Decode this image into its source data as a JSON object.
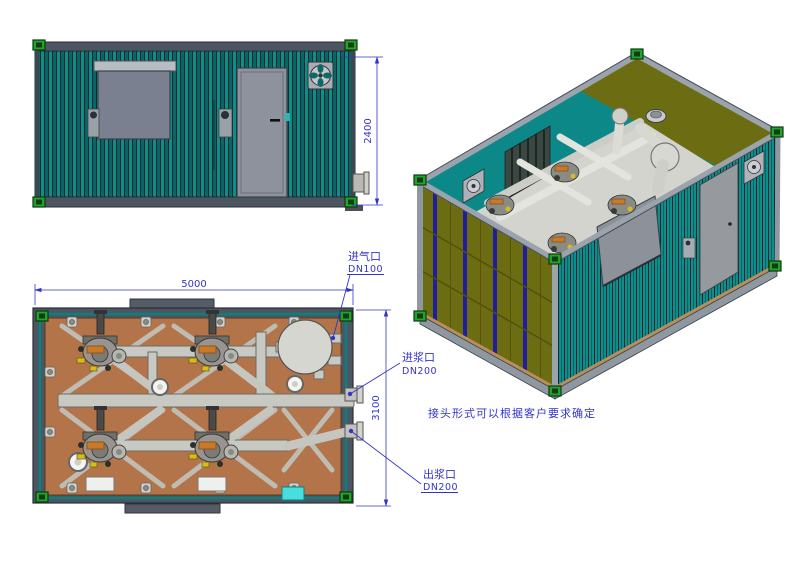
{
  "drawing": {
    "type": "cad-3view-drawing",
    "subject": "containerized-grouting-pump-station",
    "dimensions": {
      "height_mm": "2400",
      "length_mm": "5000",
      "width_mm": "3100"
    },
    "annotations": {
      "air_inlet_label": "进气口",
      "air_inlet_size": "DN100",
      "slurry_inlet_label": "进浆口",
      "slurry_inlet_size": "DN200",
      "slurry_outlet_label": "出浆口",
      "slurry_outlet_size": "DN200",
      "note": "接头形式可以根据客户要求确定"
    },
    "colors": {
      "container_teal": "#0d8787",
      "teal_dark": "#085f5f",
      "panel_olive": "#6c6c12",
      "stripe_blue": "#1e1e9e",
      "floor_brown": "#b3744a",
      "frame_gray": "#4d5560",
      "rail_light": "#9aa2ac",
      "corner_green": "#23a32c",
      "pipe_gray": "#c9c9c3",
      "orange_accent": "#c87a28",
      "valve_yellow": "#d4bc1e",
      "control_box_cyan": "#49dede",
      "annotation_blue": "#3333cc",
      "door_gray": "#8d929c",
      "window_gray": "#7b8090"
    }
  }
}
